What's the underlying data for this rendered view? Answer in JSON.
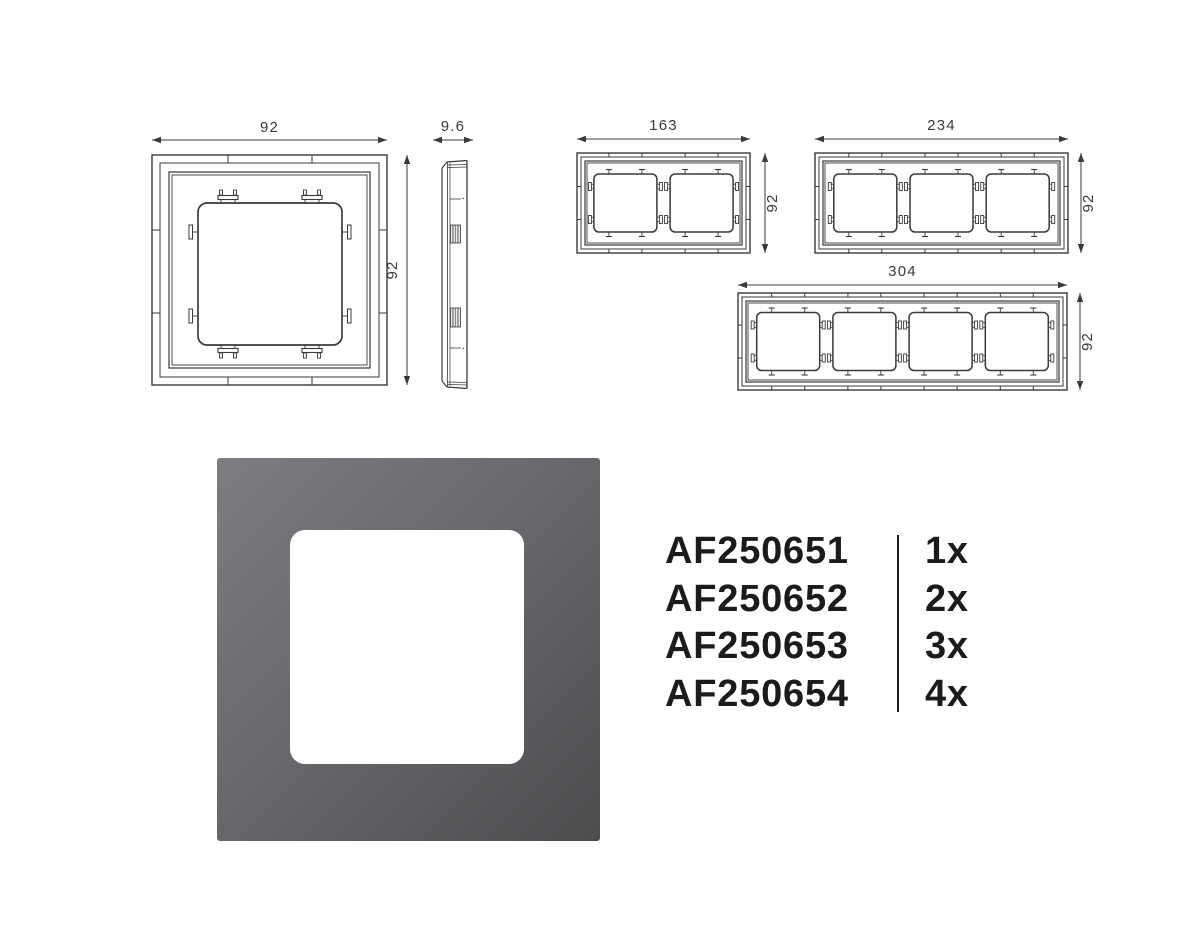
{
  "colors": {
    "background": "#ffffff",
    "line": "#3a3a3a",
    "dim_text": "#3a3a3a",
    "code_text": "#1b1b1b",
    "photo_gray_light": "#7c7d80",
    "photo_gray_mid": "#68696c",
    "photo_gray_dark": "#4c4d4f",
    "photo_opening": "#ffffff"
  },
  "drawings": {
    "front_view": {
      "width_label": "92",
      "height_label": "92"
    },
    "side_view": {
      "depth_label": "9.6"
    },
    "frame_2gang": {
      "width_label": "163",
      "height_label": "92"
    },
    "frame_3gang": {
      "width_label": "234",
      "height_label": "92"
    },
    "frame_4gang": {
      "width_label": "304",
      "height_label": "92"
    }
  },
  "codes": [
    {
      "code": "AF250651",
      "qty": "1x"
    },
    {
      "code": "AF250652",
      "qty": "2x"
    },
    {
      "code": "AF250653",
      "qty": "3x"
    },
    {
      "code": "AF250654",
      "qty": "4x"
    }
  ]
}
